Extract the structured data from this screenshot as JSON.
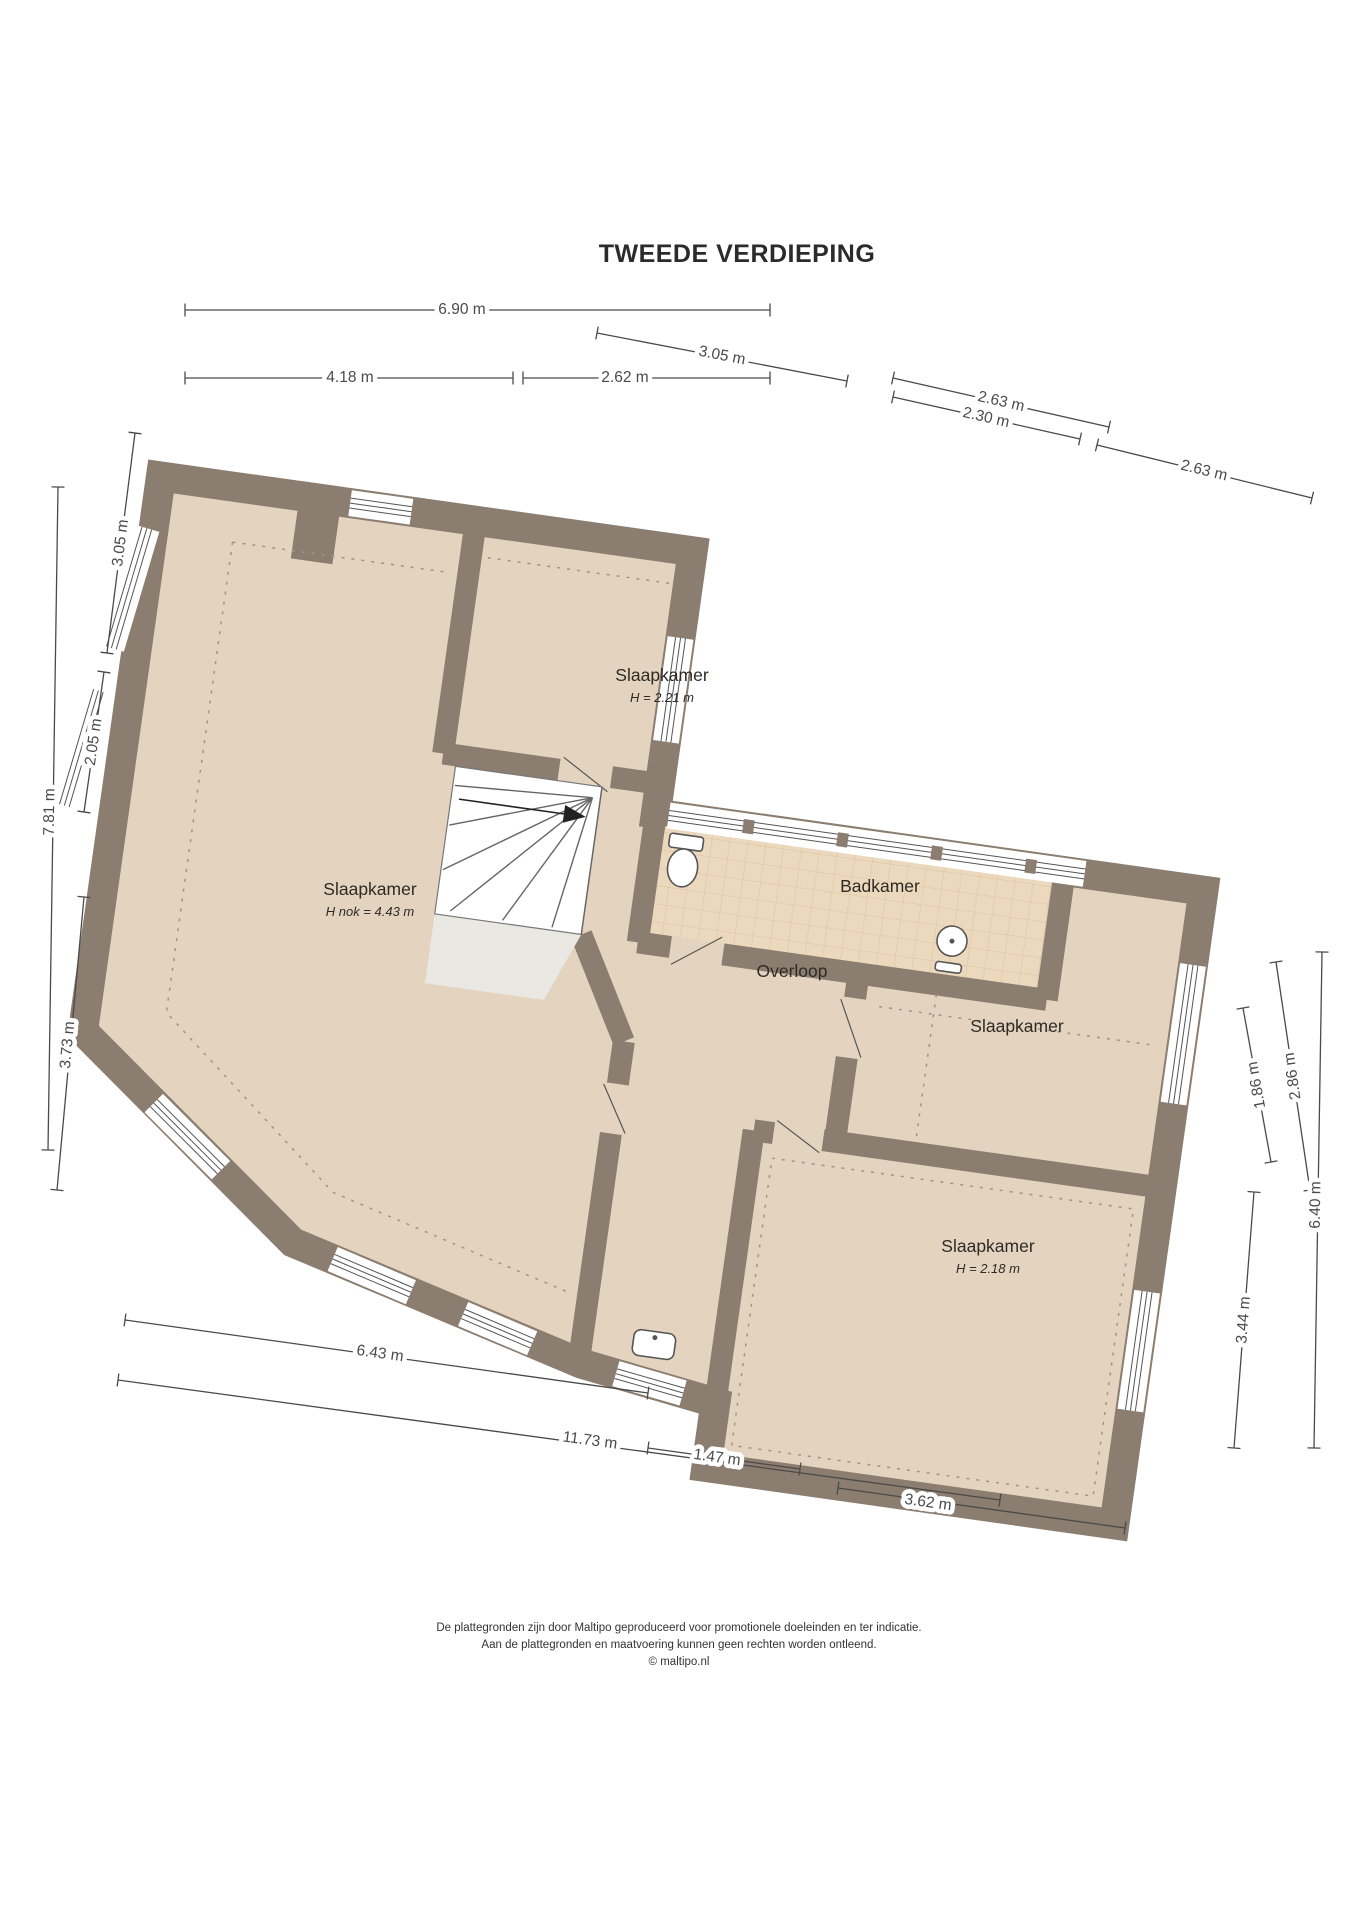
{
  "title": "TWEEDE VERDIEPING",
  "rooms": [
    {
      "label": "Slaapkamer",
      "sublabel": "H nok = 4.43 m",
      "x": 370,
      "y": 895
    },
    {
      "label": "Slaapkamer",
      "sublabel": "H = 2.21 m",
      "x": 662,
      "y": 681
    },
    {
      "label": "Badkamer",
      "sublabel": "",
      "x": 880,
      "y": 892
    },
    {
      "label": "Overloop",
      "sublabel": "",
      "x": 792,
      "y": 977
    },
    {
      "label": "Slaapkamer",
      "sublabel": "",
      "x": 1017,
      "y": 1032
    },
    {
      "label": "Slaapkamer",
      "sublabel": "H = 2.18 m",
      "x": 988,
      "y": 1252
    }
  ],
  "dimensions": [
    {
      "label": "6.90 m",
      "x1": 185,
      "y1": 310,
      "x2": 770,
      "y2": 310,
      "tx": 462,
      "ty": 310
    },
    {
      "label": "4.18 m",
      "x1": 185,
      "y1": 378,
      "x2": 513,
      "y2": 378,
      "tx": 350,
      "ty": 378
    },
    {
      "label": "2.62 m",
      "x1": 523,
      "y1": 378,
      "x2": 770,
      "y2": 378,
      "tx": 625,
      "ty": 378
    },
    {
      "label": "3.05 m",
      "x1": 597,
      "y1": 333,
      "x2": 847,
      "y2": 381,
      "tx": 722,
      "ty": 356
    },
    {
      "label": "2.63 m",
      "x1": 893,
      "y1": 378,
      "x2": 1109,
      "y2": 427,
      "tx": 1001,
      "ty": 402
    },
    {
      "label": "2.30 m",
      "x1": 893,
      "y1": 397,
      "x2": 1080,
      "y2": 439,
      "tx": 986,
      "ty": 418
    },
    {
      "label": "2.63 m",
      "x1": 1097,
      "y1": 445,
      "x2": 1312,
      "y2": 498,
      "tx": 1204,
      "ty": 471
    },
    {
      "label": "3.05 m",
      "x1": 135,
      "y1": 433,
      "x2": 107,
      "y2": 653,
      "tx": 121,
      "ty": 543
    },
    {
      "label": "7.81 m",
      "x1": 58,
      "y1": 487,
      "x2": 48,
      "y2": 1150,
      "tx": 50,
      "ty": 812
    },
    {
      "label": "2.05 m",
      "x1": 104,
      "y1": 672,
      "x2": 84,
      "y2": 812,
      "tx": 94,
      "ty": 742
    },
    {
      "label": "3.73 m",
      "x1": 84,
      "y1": 897,
      "x2": 57,
      "y2": 1190,
      "tx": 68,
      "ty": 1045
    },
    {
      "label": "1.86 m",
      "x1": 1243,
      "y1": 1008,
      "x2": 1271,
      "y2": 1162,
      "tx": 1257,
      "ty": 1085
    },
    {
      "label": "2.86 m",
      "x1": 1276,
      "y1": 962,
      "x2": 1310,
      "y2": 1190,
      "tx": 1293,
      "ty": 1076
    },
    {
      "label": "6.40 m",
      "x1": 1322,
      "y1": 952,
      "x2": 1314,
      "y2": 1448,
      "tx": 1316,
      "ty": 1205
    },
    {
      "label": "3.44 m",
      "x1": 1254,
      "y1": 1192,
      "x2": 1234,
      "y2": 1448,
      "tx": 1244,
      "ty": 1320
    },
    {
      "label": "6.43 m",
      "x1": 125,
      "y1": 1320,
      "x2": 648,
      "y2": 1393,
      "tx": 380,
      "ty": 1354
    },
    {
      "label": "11.73 m",
      "x1": 118,
      "y1": 1380,
      "x2": 1000,
      "y2": 1500,
      "tx": 590,
      "ty": 1441
    },
    {
      "label": "1.47 m",
      "x1": 648,
      "y1": 1448,
      "x2": 800,
      "y2": 1469,
      "tx": 717,
      "ty": 1458
    },
    {
      "label": "3.62 m",
      "x1": 838,
      "y1": 1488,
      "x2": 1125,
      "y2": 1528,
      "tx": 928,
      "ty": 1503
    }
  ],
  "footer": {
    "line1": "De plattegronden zijn door Maltipo geproduceerd voor promotionele doeleinden en ter indicatie.",
    "line2": "Aan de plattegronden en maatvoering kunnen geen rechten worden ontleend.",
    "line3": "© maltipo.nl"
  },
  "colors": {
    "wall": "#8b7d6f",
    "floor": "#e4d4bf",
    "bathroom_tile": "#ecd9bd",
    "tile_grid": "#d9c1a3",
    "dimension_line": "#4a4a4a",
    "text": "#2e2a26"
  }
}
